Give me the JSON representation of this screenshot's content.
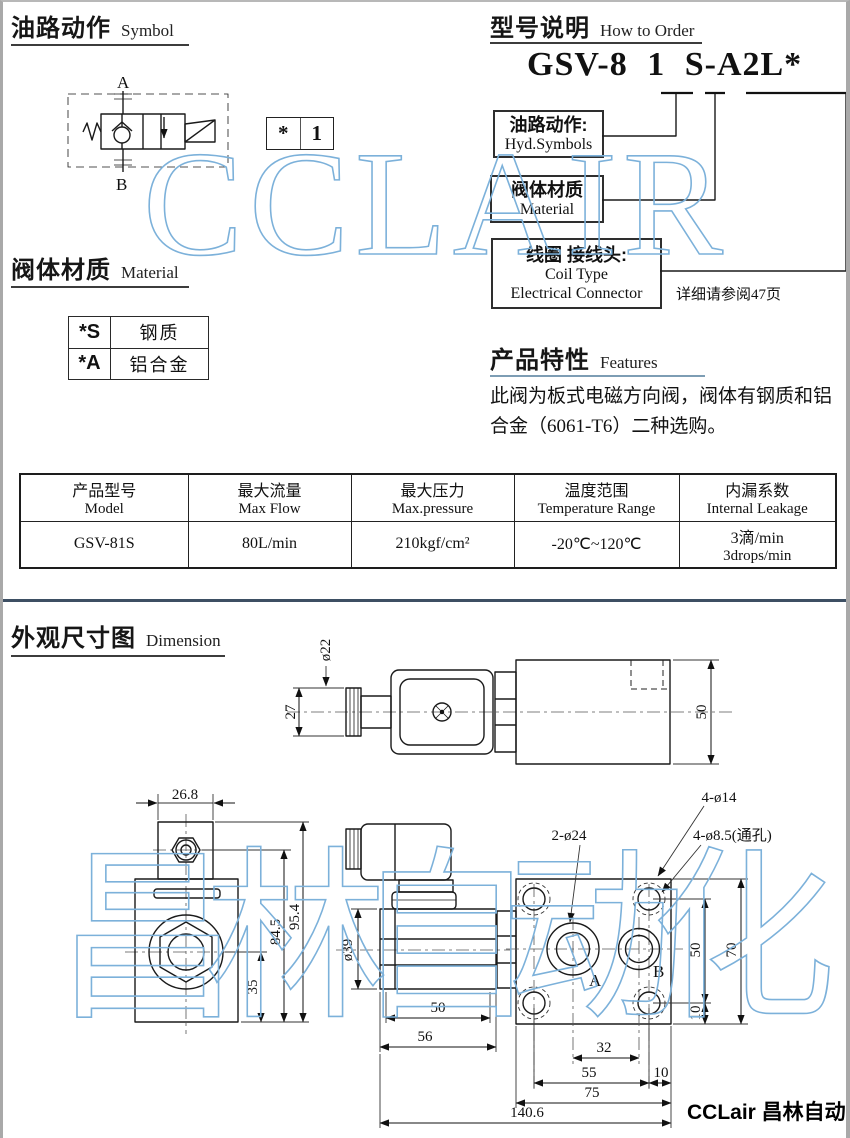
{
  "page": {
    "watermark_top": "CCLAIR",
    "watermark_bottom": "昌林自动化",
    "footer_logo": "CCLair 昌林自动化"
  },
  "symbol_section": {
    "title_zh": "油路动作",
    "title_en": "Symbol",
    "port_a": "A",
    "port_b": "B",
    "code_star": "*",
    "code_num": "1"
  },
  "order_section": {
    "title_zh": "型号说明",
    "title_en": "How to Order",
    "model_code": "GSV-8 1 S-A2L*",
    "box1_zh": "油路动作:",
    "box1_en": "Hyd.Symbols",
    "box2_zh": "阀体材质",
    "box2_en": "Material",
    "box3_zh": "线圈 接线头:",
    "box3_en1": "Coil Type",
    "box3_en2": "Electrical Connector",
    "note": "详细请参阅47页"
  },
  "material_section": {
    "title_zh": "阀体材质",
    "title_en": "Material",
    "rows": [
      {
        "code": "*S",
        "name": "钢质"
      },
      {
        "code": "*A",
        "name": "铝合金"
      }
    ]
  },
  "features_section": {
    "title_zh": "产品特性",
    "title_en": "Features",
    "text": "此阀为板式电磁方向阀，阀体有钢质和铝合金（6061-T6）二种选购。"
  },
  "spec_table": {
    "headers": [
      {
        "zh": "产品型号",
        "en": "Model"
      },
      {
        "zh": "最大流量",
        "en": "Max Flow"
      },
      {
        "zh": "最大压力",
        "en": "Max.pressure"
      },
      {
        "zh": "温度范围",
        "en": "Temperature Range"
      },
      {
        "zh": "内漏系数",
        "en": "Internal Leakage"
      }
    ],
    "row": {
      "model": "GSV-81S",
      "max_flow": "80L/min",
      "max_pressure": "210kgf/cm²",
      "temp_range": "-20℃~120℃",
      "leakage_zh": "3滴/min",
      "leakage_en": "3drops/min"
    }
  },
  "dimension_section": {
    "title_zh": "外观尺寸图",
    "title_en": "Dimension",
    "dims": {
      "d22": "ø22",
      "d27": "27",
      "d50_side": "50",
      "d26_8": "26.8",
      "d35": "35",
      "d84_5": "84.5",
      "d95_4": "95.4",
      "d39": "ø39",
      "d50_coil": "50",
      "d56": "56",
      "d2_24": "2-ø24",
      "d4_14": "4-ø14",
      "d4_85": "4-ø8.5(通孔)",
      "port_a": "A",
      "port_b": "B",
      "d50_block": "50",
      "d70": "70",
      "d10_right": "10",
      "d32": "32",
      "d55": "55",
      "d10_bottom": "10",
      "d75": "75",
      "d140_6": "140.6"
    }
  }
}
